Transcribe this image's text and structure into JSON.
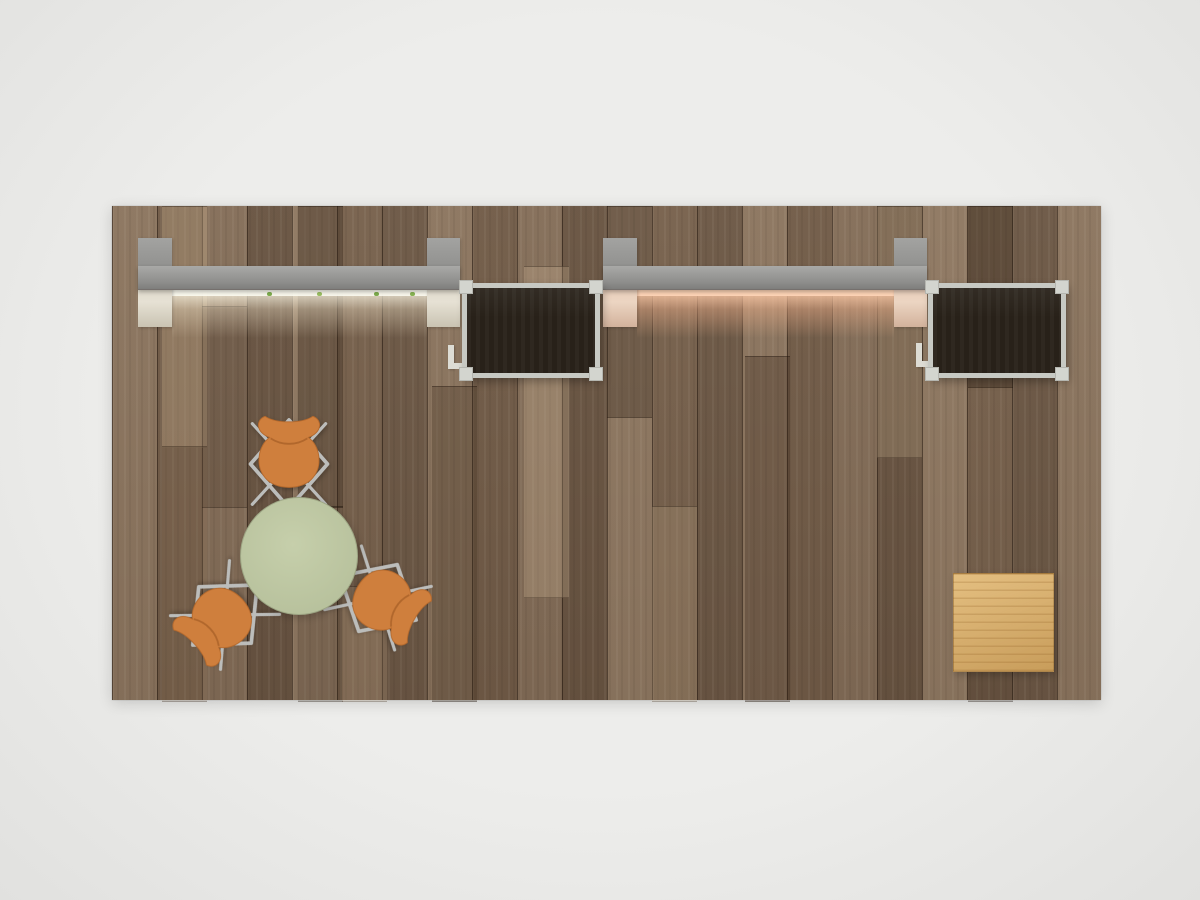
{
  "scene": {
    "title": "Overhead render of a rectangular exhibit booth",
    "background": {
      "label": "studio backdrop",
      "color": "#ededeb"
    },
    "floor": {
      "label": "wood plank flooring",
      "base_color": "#7b6551",
      "plank_direction": "vertical"
    },
    "wall_units": [
      {
        "label": "left backlit canopy wall unit",
        "canopy_color": "#8e8e8c",
        "post_color": "#9e9e9c",
        "glow_color": "#fdf6e2",
        "detail": "greenery strip under canopy"
      },
      {
        "label": "right backlit canopy wall unit",
        "canopy_color": "#8e8e8c",
        "post_color": "#9e9e9c",
        "glow_color": "#ffc9a4"
      }
    ],
    "monitors": [
      {
        "label": "left wall-mounted flat screen display",
        "frame_color": "#c7c9c3",
        "screen_color": "#282119"
      },
      {
        "label": "right wall-mounted flat screen display",
        "frame_color": "#c7c9c3",
        "screen_color": "#282119"
      }
    ],
    "meeting_set": {
      "table": {
        "label": "round cafe table",
        "top_color": "#bdc7a3"
      },
      "chairs": {
        "label": "orange molded shell chair",
        "count": 3,
        "shell_color": "#cf7f3d",
        "frame_color": "#bcbdbb"
      }
    },
    "pedestal": {
      "label": "oak cube pedestal",
      "color": "#d6ab66"
    }
  }
}
